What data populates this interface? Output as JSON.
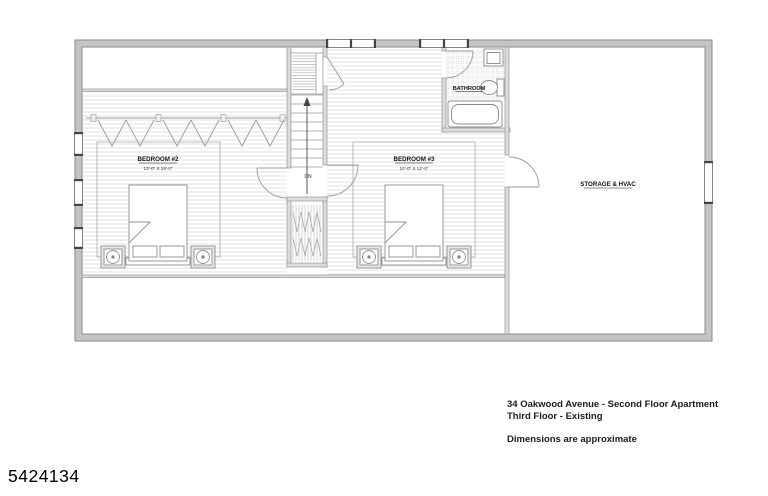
{
  "title_block": {
    "address_line": "34 Oakwood Avenue - Second Floor Apartment",
    "floor_line": "Third Floor - Existing",
    "note_line": "Dimensions are approximate"
  },
  "watermark_id": "5424134",
  "plan": {
    "rooms": {
      "bedroom2": {
        "name": "BEDROOM #2",
        "dimensions": "13'-0\" X 18'-0\""
      },
      "bedroom3": {
        "name": "BEDROOM #3",
        "dimensions": "10'-0\" X 12'-0\""
      },
      "bathroom": {
        "name": "BATHROOM"
      },
      "storage": {
        "name": "STORAGE & HVAC"
      }
    },
    "stairs": {
      "direction_label": "DN"
    }
  },
  "colors": {
    "exterior_wall": "#c4c4c4",
    "interior_wall": "#dcdcda",
    "drawing_line": "#999999",
    "floor_hatch": "#e0e0e0",
    "text": "#111111"
  }
}
